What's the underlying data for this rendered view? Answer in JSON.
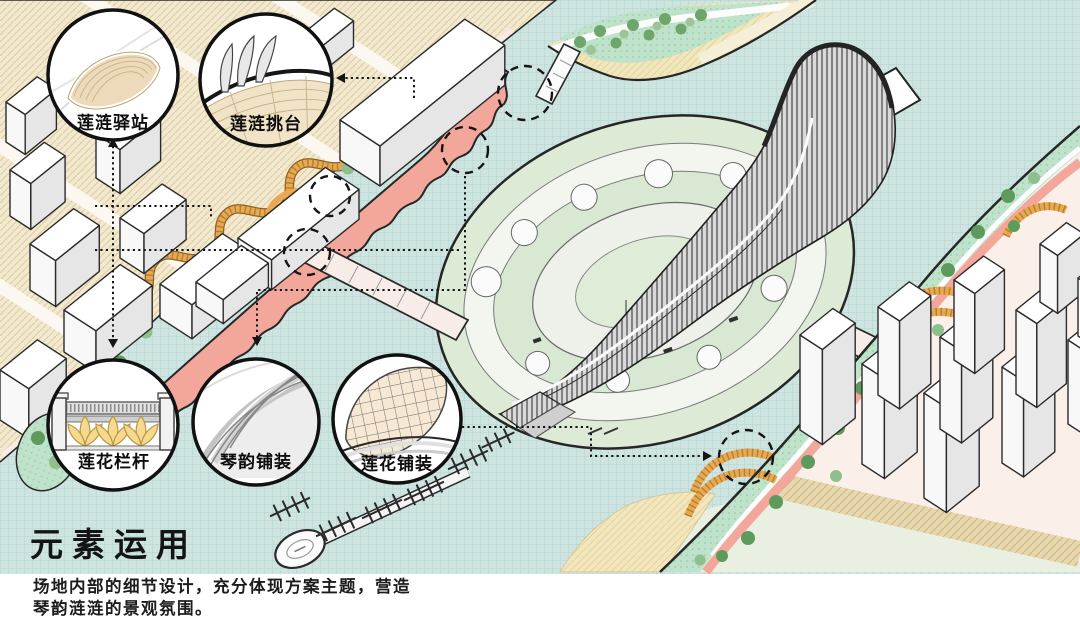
{
  "callouts": [
    {
      "id": "station",
      "label": "莲涟驿站"
    },
    {
      "id": "platform",
      "label": "莲涟挑台"
    },
    {
      "id": "railing",
      "label": "莲花栏杆"
    },
    {
      "id": "qin_paving",
      "label": "琴韵铺装"
    },
    {
      "id": "lotus_paving",
      "label": "莲花铺装"
    }
  ],
  "section": {
    "title": "元素运用",
    "description_line1": "场地内部的细节设计，充分体现方案主题，营造",
    "description_line2": "琴韵涟涟的景观氛围。"
  },
  "palette": {
    "water": "#cde4e1",
    "water_grid": "#b2d4d1",
    "promenade_pink": "#f2a79a",
    "ribbon_orange": "#e9a851",
    "mint_green": "#bfe2ca",
    "island_green": "#dcead6",
    "city_beige": "#f3e9cf",
    "sand": "#f2e6bd",
    "building_white": "#ffffff",
    "outline": "#262626"
  }
}
